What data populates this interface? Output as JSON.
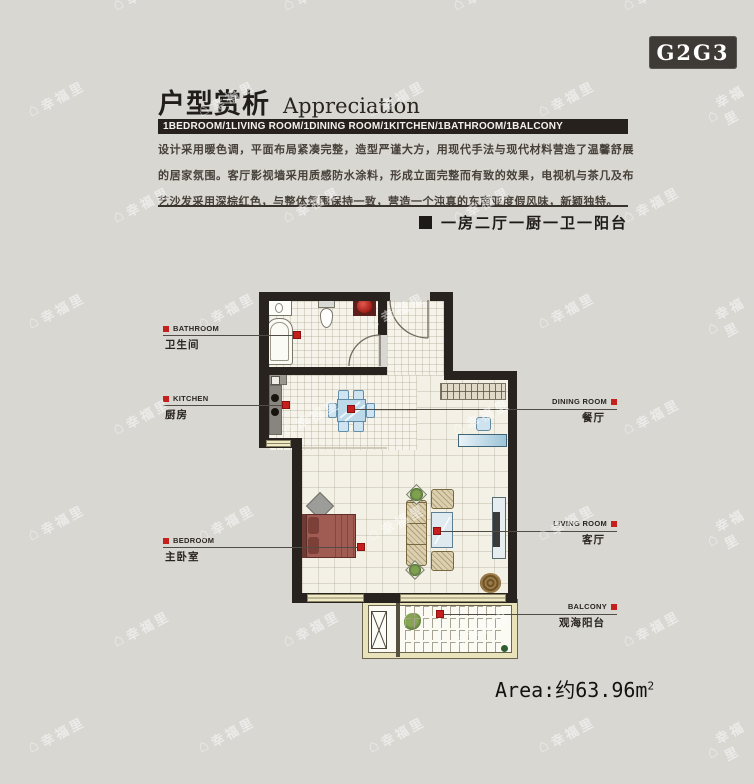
{
  "badge": {
    "label": "G2G3"
  },
  "header": {
    "title_cn": "户型赏析",
    "title_en": "Appreciation",
    "room_bar": "1BEDROOM/1LIVING ROOM/1DINING ROOM/1KITCHEN/1BATHROOM/1BALCONY",
    "description": "设计采用暖色调，平面布局紧凑完整，造型严谨大方，用现代手法与现代材料营造了温馨舒展的居家氛围。客厅影视墙采用质感防水涂料，形成立面完整而有致的效果，电视机与茶几及布艺沙发采用深棕红色，与整体氛围保持一致，营造一个沌真的东南亚度假风味，新颖独特。",
    "subtitle": "一房二厅一厨一卫一阳台"
  },
  "floor_plan": {
    "labels": {
      "bathroom": {
        "en": "BATHROOM",
        "cn": "卫生间"
      },
      "kitchen": {
        "en": "KITCHEN",
        "cn": "厨房"
      },
      "bedroom": {
        "en": "BEDROOM",
        "cn": "主卧室"
      },
      "dining_room": {
        "en": "DINING ROOM",
        "cn": "餐厅"
      },
      "living_room": {
        "en": "LIVING ROOM",
        "cn": "客厅"
      },
      "balcony": {
        "en": "BALCONY",
        "cn": "观海阳台"
      }
    }
  },
  "area": {
    "text": "Area:约63.96m",
    "sup": "2"
  },
  "watermark": {
    "icon": "⌂",
    "text": "幸福里"
  },
  "colors": {
    "accent_red": "#c6201e",
    "wall": "#29231f",
    "bar_bg": "#26211d",
    "background": "#d9d7d2"
  }
}
